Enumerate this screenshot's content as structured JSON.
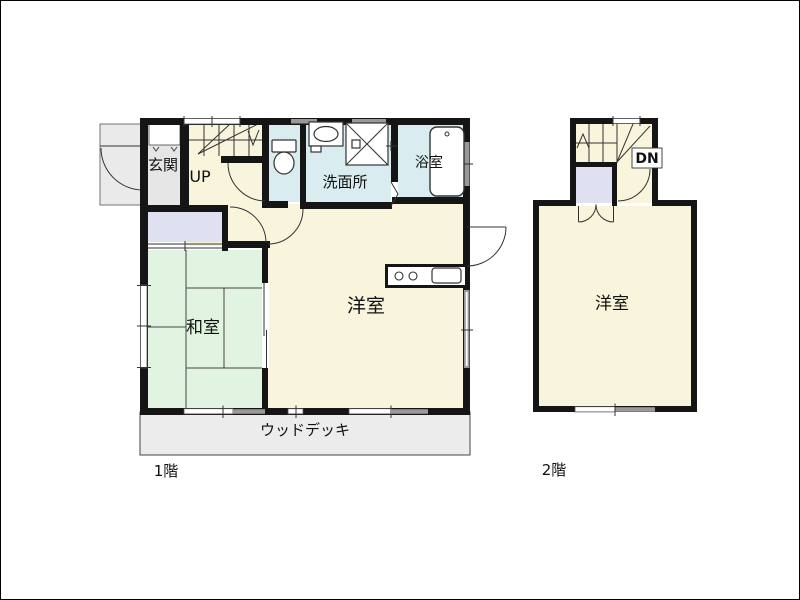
{
  "colors": {
    "wall": "#151515",
    "line": "#333333",
    "room_cream": "#f8f5dc",
    "room_cyan": "#d9edf0",
    "tatami_green": "#e1f3e1",
    "closet_lavender": "#e0e0f3",
    "entrance_gray": "#e6e6e6",
    "porch_gray": "#eaeaea",
    "deck_gray": "#ececec",
    "window_gray": "#999999"
  },
  "floor1": {
    "label": "1階",
    "entrance": "玄関",
    "stairs": "UP",
    "washroom": "洗面所",
    "bathroom": "浴室",
    "japanese_room": "和室",
    "western_room": "洋室",
    "wood_deck": "ウッドデッキ"
  },
  "floor2": {
    "label": "2階",
    "stairs": "DN",
    "western_room": "洋室"
  }
}
